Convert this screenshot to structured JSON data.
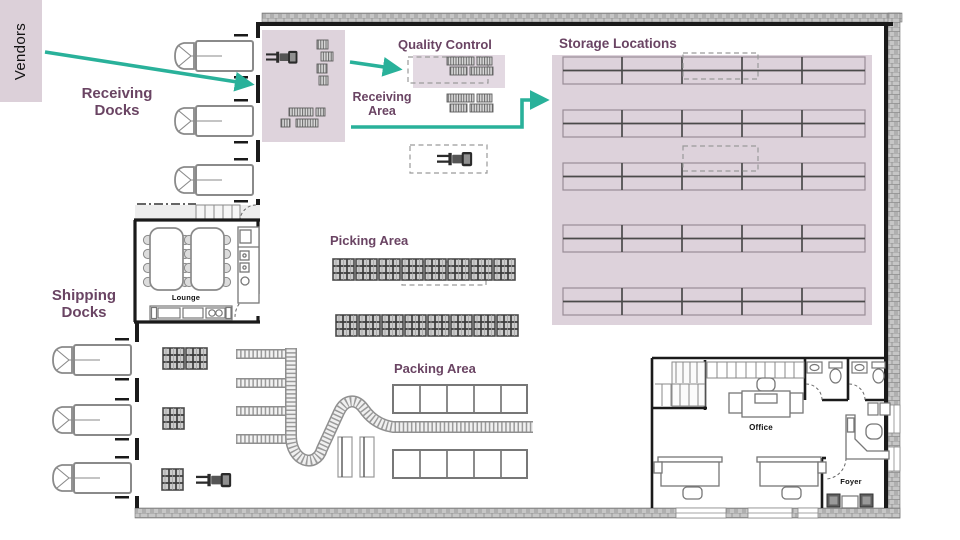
{
  "title": "Warehouse floor plan diagram",
  "colors": {
    "accent_arrow": "#29b19a",
    "area_fill": "#ded3dc",
    "vendors_fill": "#dcd0d9",
    "label_purple": "#6a4463",
    "wall_black": "#1a1a1a",
    "wall_hatch_gray": "#c2c2c2"
  },
  "labels": {
    "vendors": "Vendors",
    "receiving_docks": "Receiving Docks",
    "quality_control": "Quality Control",
    "receiving_area": "Receiving Area",
    "storage_locations": "Storage Locations",
    "picking_area": "Picking Area",
    "packing_area": "Packing Area",
    "shipping_docks": "Shipping Docks",
    "lounge": "Lounge",
    "office": "Office",
    "foyer": "Foyer"
  },
  "counts": {
    "receiving_dock_trucks": 3,
    "shipping_dock_trucks": 3,
    "storage_rack_rows": 5,
    "storage_rack_columns": 5,
    "picking_pallet_rows": 2,
    "picking_pallets_per_row": 8,
    "packing_tables_per_row": 5,
    "forklifts": 3
  }
}
